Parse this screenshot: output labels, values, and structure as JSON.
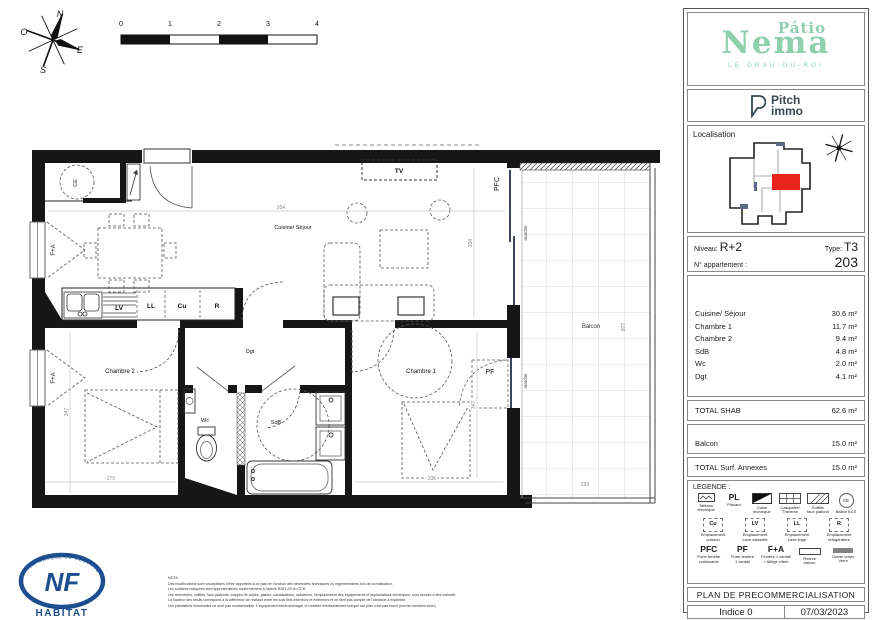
{
  "page": {
    "compass": {
      "n": "N",
      "o": "O",
      "e": "E",
      "s": "S"
    },
    "scale_bar": {
      "ticks": [
        "0",
        "1",
        "2",
        "3",
        "4"
      ]
    }
  },
  "plan": {
    "rooms": {
      "sejour": "Cuisine/ Séjour",
      "chambre1": "Chambre 1",
      "chambre2": "Chambre 2",
      "wc": "Wc",
      "sdb": "SdB",
      "dgt": "Dgt",
      "balcon": "Balcon"
    },
    "labels": {
      "tv": "TV",
      "pfc": "PFC",
      "pf": "PF",
      "fa": "F+A",
      "ce": "CE",
      "marche": "marche",
      "lv": "LV",
      "ll": "LL",
      "cu": "Cu",
      "r": "R"
    },
    "dims": {
      "sejour_w": "954",
      "sejour_d": "334",
      "chambre2_d": "347",
      "chambre2_w": "270",
      "chambre1_w": "336",
      "chambre1_d": "347",
      "balcon_d": "677",
      "balcon_w": "223"
    }
  },
  "sidebar": {
    "brand": {
      "line1": "Pátio",
      "line2": "Nema",
      "subtitle": "LE GRAU-DU-ROI"
    },
    "developer": {
      "line1": "Pitch",
      "line2": "immo"
    },
    "localisation": {
      "title": "Localisation"
    },
    "unit": {
      "niveau_label": "Niveau:",
      "niveau": "R+2",
      "type_label": "Type:",
      "type": "T3",
      "apartment_label": "N° appartement :",
      "apartment_number": "203"
    },
    "areas": [
      {
        "label": "Cuisine/ Séjour",
        "value": "30.6 m²"
      },
      {
        "label": "Chambre 1",
        "value": "11.7 m²"
      },
      {
        "label": "Chambre 2",
        "value": "9.4 m²"
      },
      {
        "label": "SdB",
        "value": "4.8 m²"
      },
      {
        "label": "Wc",
        "value": "2.0 m²"
      },
      {
        "label": "Dgt",
        "value": "4.1 m²"
      }
    ],
    "total_shab": {
      "label": "TOTAL SHAB",
      "value": "62.6 m²"
    },
    "annexe": {
      "label": "Balcon",
      "value": "15.0 m²"
    },
    "total_annexes": {
      "label": "TOTAL Surf. Annexes",
      "value": "15.0 m²"
    },
    "legend": {
      "title": "LEGENDE :",
      "row1": [
        {
          "label": "Tableau\nélectrique"
        },
        {
          "code": "PL",
          "label": "Placard"
        },
        {
          "label": "Gaine technique"
        },
        {
          "label": "Casquette/\nTraverse"
        },
        {
          "label": "Soffite/\nfaux plafond"
        },
        {
          "code": "CE",
          "label": "Ballon ECS"
        }
      ],
      "row2": [
        {
          "code": "Cu",
          "label": "Emplacement\ncuisson"
        },
        {
          "code": "LV",
          "label": "Emplacement\nLave vaisselle"
        },
        {
          "code": "LL",
          "label": "Emplacement\nLave linge"
        },
        {
          "code": "R",
          "label": "Emplacement\nréfrigérateur"
        }
      ],
      "row3": [
        {
          "code": "PFC",
          "label": "Porte fenêtre\ncoulissante"
        },
        {
          "code": "PF",
          "label": "Porte fenêtre\n1 vantail"
        },
        {
          "code": "F+A",
          "label": "Fenêtre 1 vantail\n+ Allège vitrée"
        },
        {
          "label": "Relevé\nbalcon"
        },
        {
          "label": "Garde corps\nVerre"
        }
      ]
    },
    "plan_title": "PLAN DE PRECOMMERCIALISATION",
    "indice": "Indice 0",
    "date": "07/03/2023"
  },
  "footer": {
    "nf_logo": {
      "acronym": "NF",
      "name": "HABITAT",
      "ring_text": "LA MARQUE DE CERTIFICATION"
    },
    "nota": {
      "title": "NOTA :",
      "lines": [
        "Des modifications sont susceptibles d'être apportées à ce plan en fonction des nécessités techniques ou réglementaires lors de la réalisation.",
        "Les surfaces indiquées sont approximatives conformément à l'article R261-25 du CCH.",
        "Les retombées, soffites, faux-plafonds, trappes de visites, gaines, canalisations, radiateurs, l'emplacement des équipements et implantations électriques, sont donnés à titre indicatif.",
        "La hauteur des seuils correspond à la différence de niveaux entre les sols finis intérieurs et extérieurs et ne tient pas compte de l'obstacle à enjamber.",
        "Les plantations éventuelles ne sont pas contractuelles. L'équipement électroménager et mobilier éventuellement indiqué sur plan n'est pas fourni (hormis meubles évier)."
      ]
    }
  },
  "colors": {
    "brand_mint": "#8ecfae",
    "developer_slate": "#37474f",
    "unit_red": "#e8231c",
    "nf_blue": "#1d4e8f"
  }
}
